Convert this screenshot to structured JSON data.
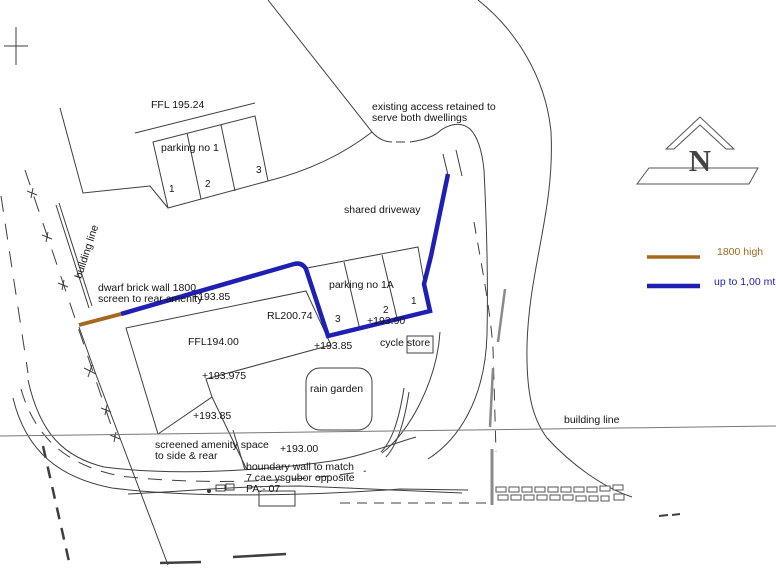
{
  "page": {
    "background": "#ffffff"
  },
  "colors": {
    "wall_1800": "#a5681f",
    "wall_low": "#1f1fb4",
    "linework": "#3f3f3f",
    "grey_boundary": "#8a8a8a",
    "text": "#141414"
  },
  "labels": {
    "ffl_195_24": "FFL 195.24",
    "parking_no_1": "parking no 1",
    "bay1_1": "1",
    "bay1_2": "2",
    "bay1_3": "3",
    "existing_access_line1": "existing access retained to",
    "existing_access_line2": "serve both dwellings",
    "shared_driveway": "shared driveway",
    "building_line_left": "building line",
    "dwarf_wall_line1": "dwarf brick wall 1800",
    "dwarf_wall_line2": "screen to rear amenity",
    "level_193_85_a": "+193.85",
    "parking_no_1a": "parking no 1A",
    "bay1a_3": "3",
    "bay1a_2": "2",
    "bay1a_1": "1",
    "rl_200_74": "RL200.74",
    "level_193_90": "+193.90",
    "level_193_85_b": "+193.85",
    "cycle_store": "cycle store",
    "ffl_194_00": "FFL194.00",
    "level_193_975": "+193.975",
    "rain_garden": "rain garden",
    "level_193_85_c": "+193.85",
    "screened_line1": "screened amenity space",
    "screened_line2": "to side & rear",
    "level_193_00": "+193.00",
    "boundary_line1": "boundary wall to match",
    "boundary_line2": "7 cae ysgubor opposite",
    "boundary_line3": "PA:- 07",
    "building_line_right": "building line"
  },
  "legend": {
    "items": [
      {
        "label": "1800 high",
        "color": "#a5681f"
      },
      {
        "label": "up to 1,00 mtr",
        "color": "#1f1fb4"
      }
    ]
  },
  "north_indicator": {
    "letter": "N"
  }
}
